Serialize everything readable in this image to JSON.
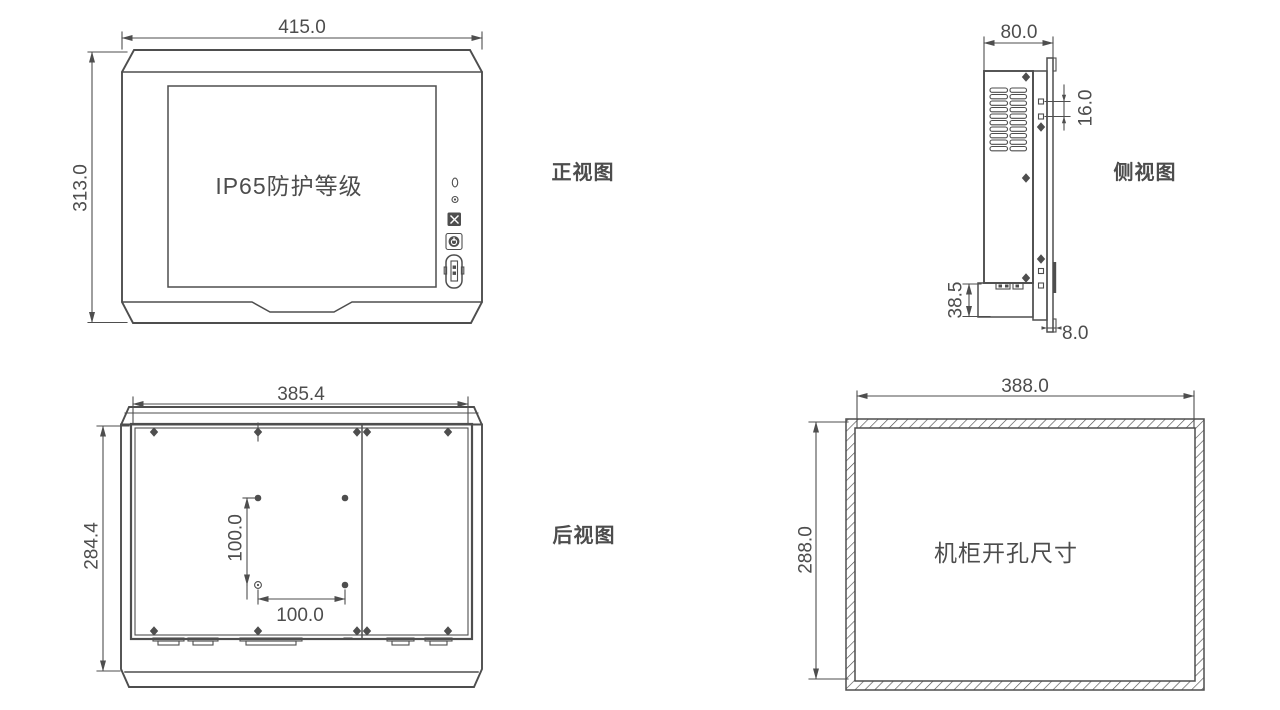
{
  "colors": {
    "line": "#4e4e4e",
    "text": "#4d4d4d",
    "background": "#ffffff"
  },
  "views": {
    "front": {
      "label": "正视图",
      "screen_text": "IP65防护等级",
      "width": "415.0",
      "height": "313.0"
    },
    "side": {
      "label": "侧视图",
      "depth": "80.0",
      "port_spacing": "16.0",
      "bottom_height": "38.5",
      "bezel_depth": "8.0"
    },
    "rear": {
      "label": "后视图",
      "width": "385.4",
      "height": "284.4",
      "vesa_vertical": "100.0",
      "vesa_horizontal": "100.0"
    },
    "cutout": {
      "label": "机柜开孔尺寸",
      "width": "388.0",
      "height": "288.0"
    }
  }
}
